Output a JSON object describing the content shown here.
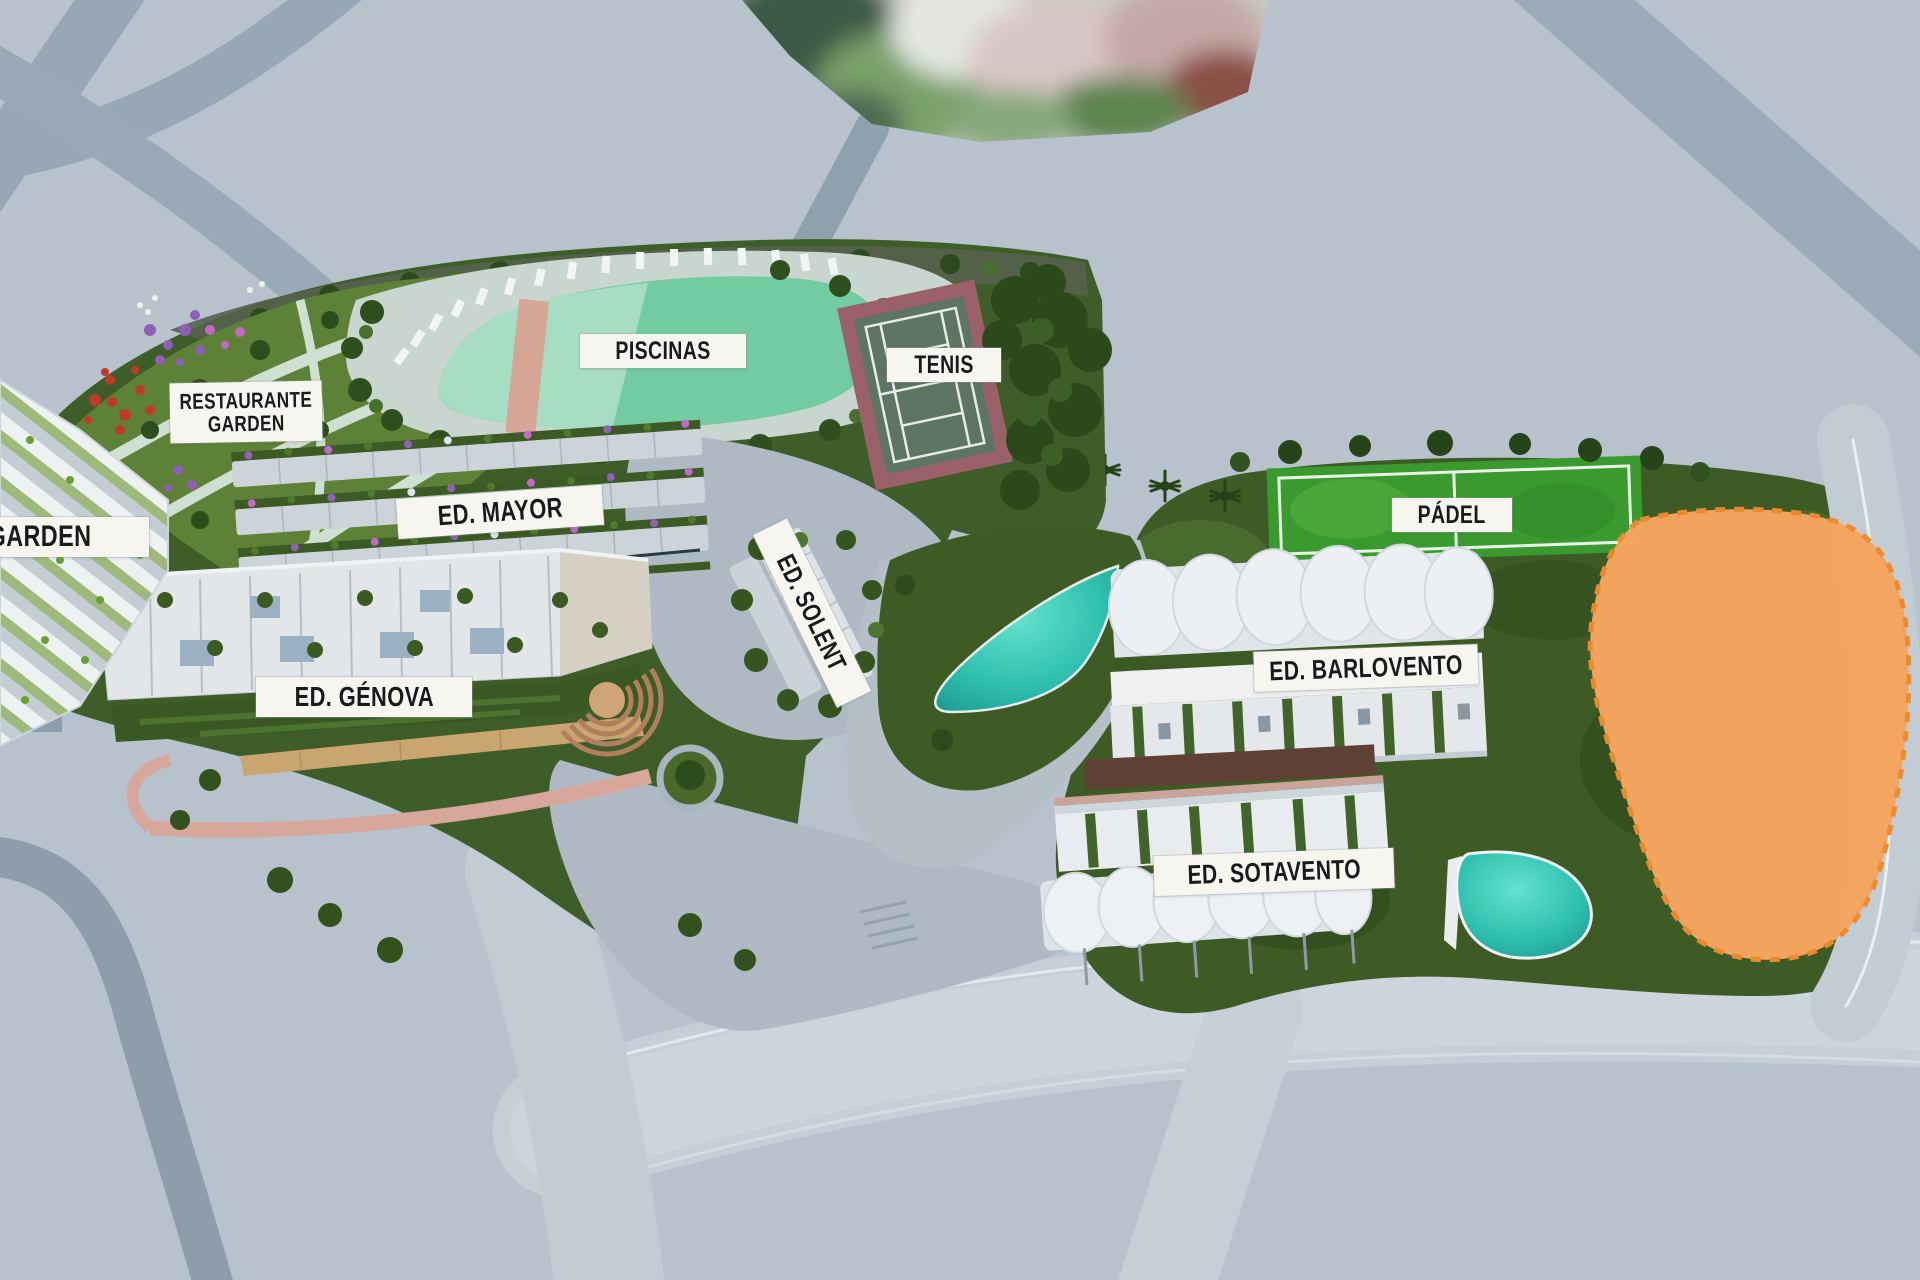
{
  "plan": {
    "kind": "residential-masterplan-aerial-render",
    "labels": {
      "garden": {
        "text": "GARDEN"
      },
      "restaurante_garden": {
        "line1": "RESTAURANTE",
        "line2": "GARDEN"
      },
      "piscinas": {
        "text": "PISCINAS"
      },
      "tenis": {
        "text": "TENIS"
      },
      "ed_mayor": {
        "text": "ED. MAYOR"
      },
      "ed_genova": {
        "text": "ED. GÉNOVA"
      },
      "ed_solent": {
        "text": "ED. SOLENT"
      },
      "padel": {
        "text": "PÁDEL"
      },
      "ed_barlovento": {
        "text": "ED. BARLOVENTO"
      },
      "ed_sotavento": {
        "text": "ED. SOTAVENTO"
      }
    },
    "colors": {
      "background": "#b7c2cc",
      "road_dark": "#93a3b1",
      "road_light": "#c6cfd7",
      "site_green": "#3f5d28",
      "garden_green": "#5d8136",
      "pool_mint": "#72cba1",
      "pond_teal": "#2fbfae",
      "padel_green": "#3a9a30",
      "tennis_border": "#9a6168",
      "tennis_court": "#5d7561",
      "building_white": "#e9edef",
      "future_parcel_orange": "#f6a55f",
      "future_parcel_border": "#ee8a2e",
      "label_bg": "#f6f5ef",
      "label_text": "#191a1c"
    }
  }
}
